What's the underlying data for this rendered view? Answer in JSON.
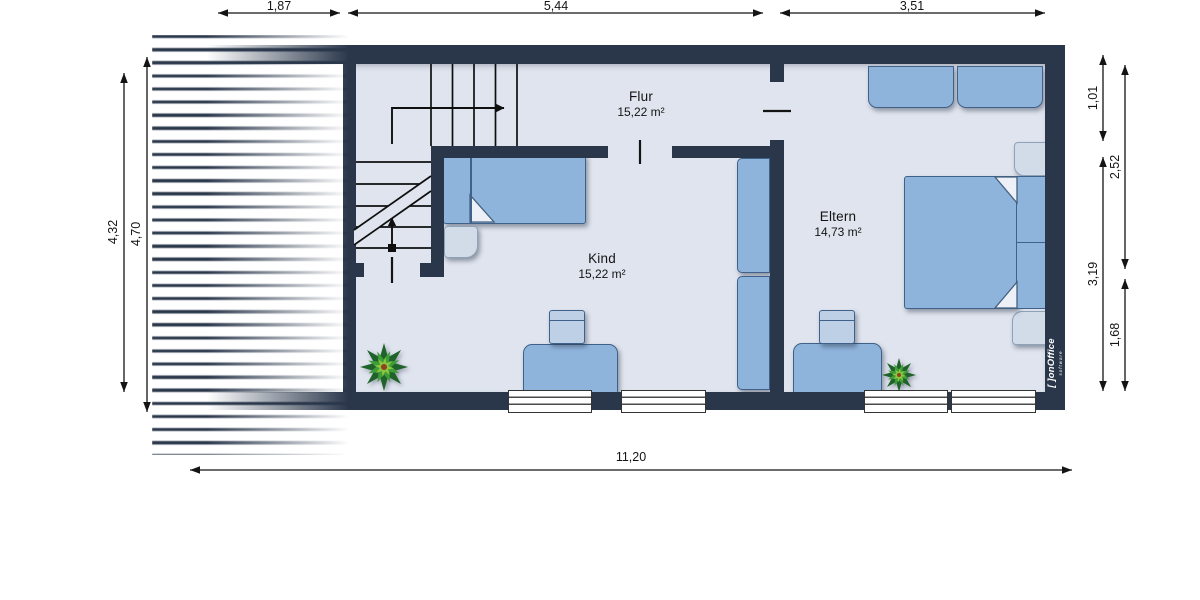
{
  "document": {
    "type": "floor-plan",
    "floor_name": "Obergeschoss"
  },
  "colors": {
    "wall": "#2a374b",
    "floor": "#dfe4ee",
    "furn": "#8fb4dc",
    "furnb": "#3f618a",
    "lightf": "#d2dbe8",
    "lightb": "#8ea2b8",
    "chair": "#bdd0e5",
    "ink": "#141414",
    "green1": "#1f632b",
    "green2": "#3f9e38",
    "green3": "#8dc63f"
  },
  "rooms": [
    {
      "name": "Flur",
      "area": "15,22 m²"
    },
    {
      "name": "Kind",
      "area": "15,22 m²"
    },
    {
      "name": "Eltern",
      "area": "14,73 m²"
    }
  ],
  "dimensions": {
    "top": [
      "1,87",
      "5,44",
      "3,51"
    ],
    "left": [
      "4,32",
      "4,70"
    ],
    "right": [
      "1,01",
      "2,52",
      "3,19",
      "1,68"
    ],
    "bottom": [
      "11,20"
    ]
  },
  "logo": {
    "name": "[ ]onOffice",
    "tagline": "software"
  }
}
